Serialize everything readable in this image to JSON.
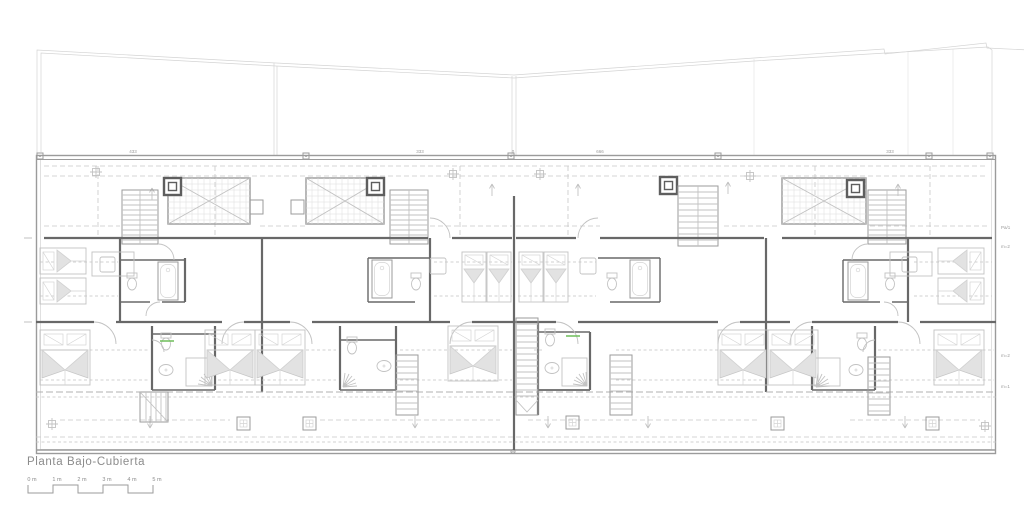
{
  "drawing": {
    "title": "Planta  Bajo-Cubierta",
    "type_note": "architectural attic floor plan, four dwelling units, grey linework on white"
  },
  "scale_bar": {
    "unit_labels": [
      "0 m",
      "1 m",
      "2 m",
      "3 m",
      "4 m",
      "5 m"
    ]
  },
  "annotations": {
    "top_dimensions": [
      {
        "text": "433",
        "x": 133
      },
      {
        "text": "333",
        "x": 420
      },
      {
        "text": "0",
        "x": 513
      },
      {
        "text": "666",
        "x": 600
      },
      {
        "text": "333",
        "x": 890
      }
    ],
    "right_margin": [
      {
        "text": "Pa/1",
        "y": 229
      },
      {
        "text": "m=2",
        "y": 248
      },
      {
        "text": "m=2",
        "y": 357
      },
      {
        "text": "m=1",
        "y": 388
      }
    ],
    "bottom_center": [
      {
        "text": "0",
        "x": 513
      }
    ]
  },
  "colors": {
    "background": "#ffffff",
    "wall_dark": "#686868",
    "line_mid": "#9b9b9b",
    "line_light": "#c2c2c2",
    "accent_green": "#6fbe5a",
    "text_gray": "#8c8c8c"
  }
}
